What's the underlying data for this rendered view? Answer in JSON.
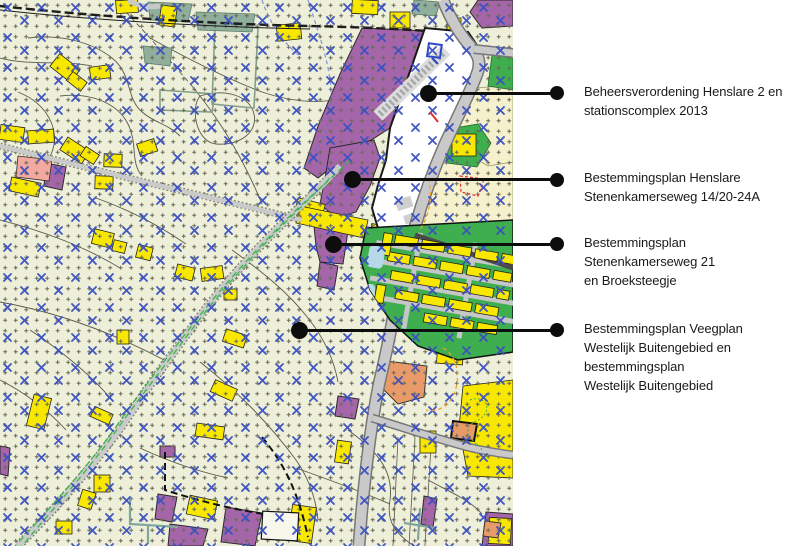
{
  "page": {
    "background": "#ffffff"
  },
  "map": {
    "description": "Overview zoning map with four plan areas marked by callouts",
    "colors": {
      "background": "#edefd9",
      "cross_blue": "#3b50c1",
      "grid_plus": "#6a6a58",
      "building_yellow": "#f8e800",
      "plan_purple": "#a566a9",
      "green_area": "#3fae4e",
      "salmon_orange": "#e89a68",
      "pink_area": "#f3a8a0",
      "teal_area": "#8fae9b",
      "road_gray": "#c9c9c9",
      "white_plan_area": "#ffffff",
      "cream_area": "#f5f1cd",
      "water_blue": "#b7d8e6"
    }
  },
  "annotations": {
    "items": [
      {
        "id": "beheersverordening-henslare-2",
        "label": "Beheersverordening Henslare 2 en\nstationscomplex 2013"
      },
      {
        "id": "bestemmingsplan-henslare",
        "label": "Bestemmingsplan Henslare\nStenenkamerseweg 14/20-24A"
      },
      {
        "id": "bestemmingsplan-stenenkamerseweg-21",
        "label": "Bestemmingsplan\nStenenkamerseweg 21\nen Broeksteegje"
      },
      {
        "id": "bestemmingsplan-veegplan",
        "label": "Bestemmingsplan Veegplan\nWestelijk Buitengebied en\nbestemmingsplan\nWestelijk Buitengebied"
      }
    ]
  }
}
